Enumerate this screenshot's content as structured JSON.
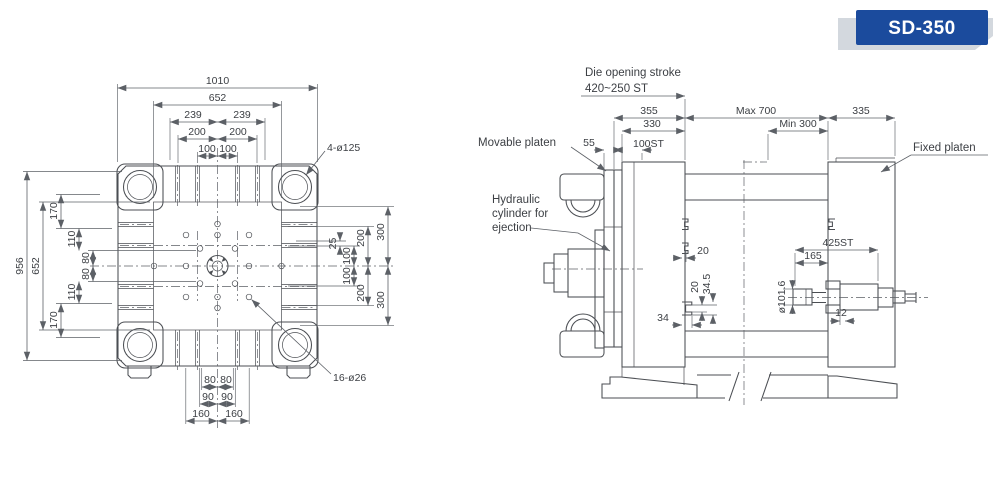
{
  "colors": {
    "drawing_line": "#4b4e53",
    "dimension_line": "#5c6066",
    "text": "#3d4045",
    "badge_blue": "#1b4b9d",
    "badge_gray": "#d3d8de",
    "background": "#ffffff"
  },
  "badge": {
    "model": "SD-350"
  },
  "front_view": {
    "top_dims": {
      "overall_width": "1010",
      "face_width": "652",
      "rib_a_left": "239",
      "rib_a_right": "239",
      "rib_b_left": "200",
      "rib_b_right": "200",
      "rib_c_left": "100",
      "rib_c_right": "100"
    },
    "left_dims": {
      "overall_height": "956",
      "face_height": "652",
      "chain_top_170": "170",
      "chain_top_110": "110",
      "chain_top_80": "80",
      "chain_bottom_80": "80",
      "chain_bottom_110": "110",
      "chain_bottom_170": "170"
    },
    "right_dims": {
      "offset_25": "25",
      "upper_100": "100",
      "lower_100": "100",
      "upper_200": "200",
      "lower_200": "200",
      "upper_300": "300",
      "lower_300": "300"
    },
    "bottom_dims": {
      "slot_a_left": "80",
      "slot_a_right": "80",
      "slot_b_left": "90",
      "slot_b_right": "90",
      "slot_c_left": "160",
      "slot_c_right": "160"
    },
    "callouts": {
      "tie_bar_holes": "4-ø125",
      "mounting_holes": "16-ø26"
    }
  },
  "side_view": {
    "labels": {
      "die_opening_stroke": "Die opening stroke",
      "die_opening_stroke_value": "420~250 ST",
      "movable_platen": "Movable platen",
      "hydraulic_line1": "Hydraulic",
      "hydraulic_line2": "cylinder for",
      "hydraulic_line3": "ejection",
      "fixed_platen": "Fixed platen"
    },
    "dims": {
      "platen_355": "355",
      "platen_330": "330",
      "ejector_stroke": "100ST",
      "plate_55": "55",
      "max_daylight": "Max 700",
      "min_daylight": "Min 300",
      "fixed_335": "335",
      "slot_20_face": "20",
      "slot_20": "20",
      "slot_34_5": "34.5",
      "slot_34": "34",
      "injection_stroke": "425ST",
      "sleeve_165": "165",
      "plunger_dia": "ø101.6",
      "flange_12": "12"
    }
  }
}
